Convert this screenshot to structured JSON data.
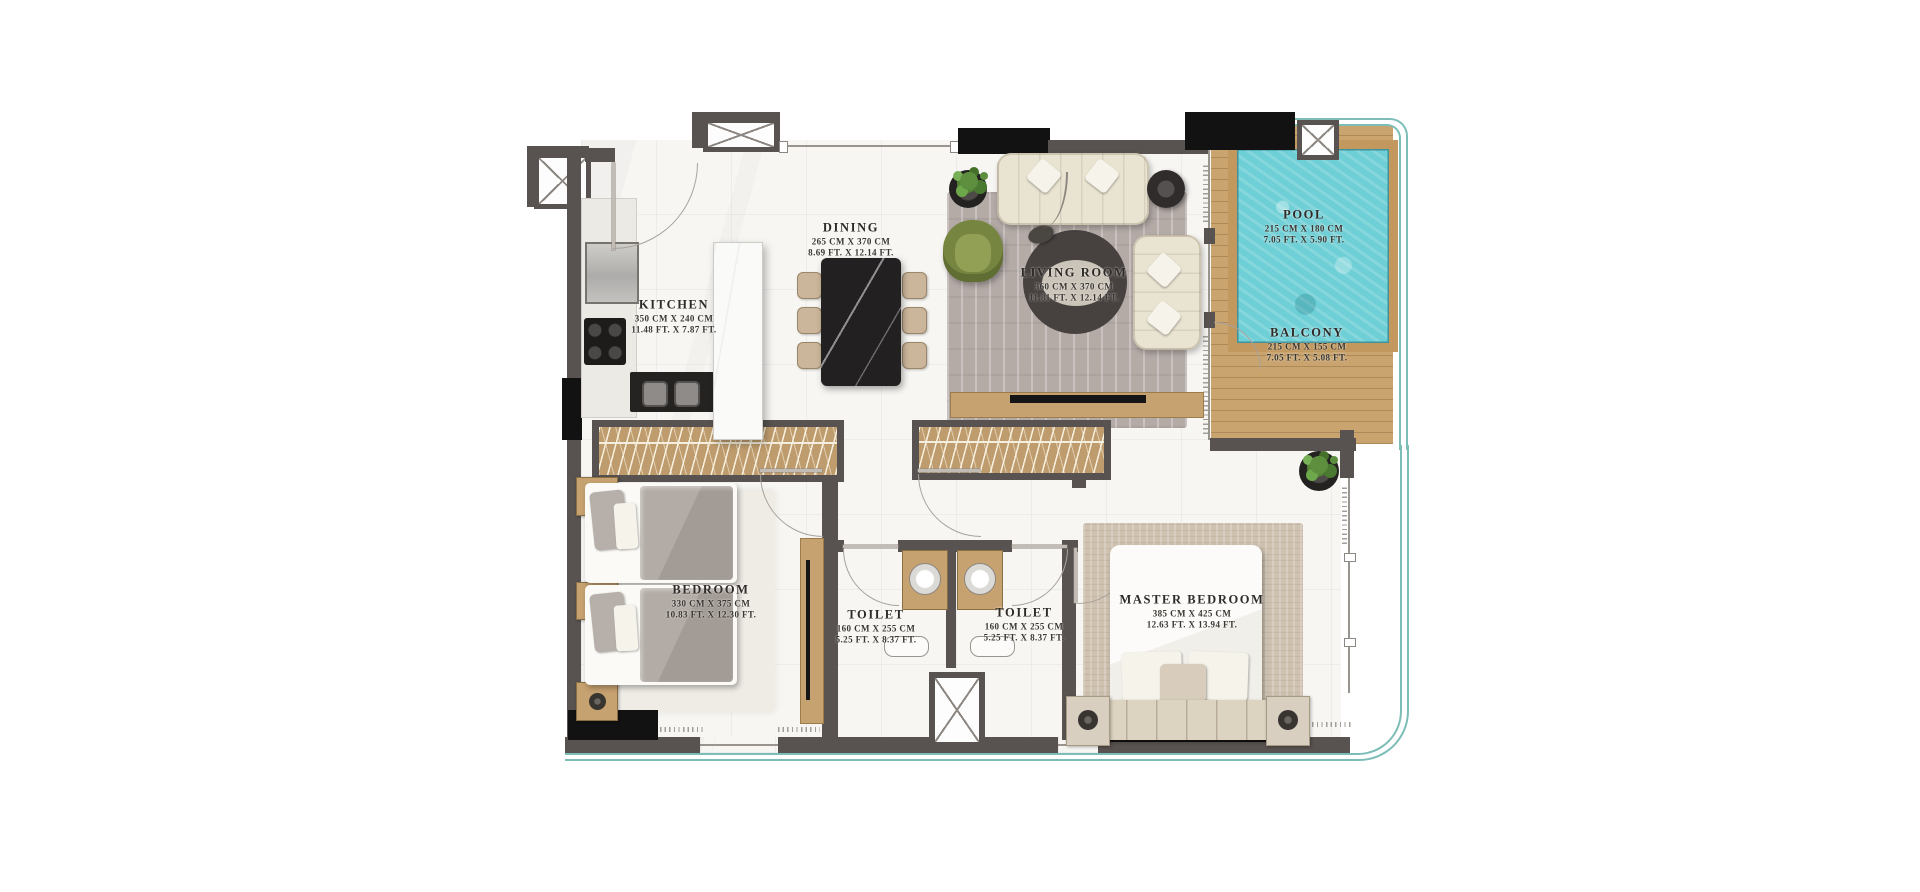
{
  "rooms": [
    {
      "id": "kitchen",
      "name": "KITCHEN",
      "cm": "350 CM X 240 CM",
      "ft": "11.48 FT. X 7.87 FT."
    },
    {
      "id": "dining",
      "name": "DINING",
      "cm": "265 CM X 370 CM",
      "ft": "8.69 FT. X 12.14 FT."
    },
    {
      "id": "living",
      "name": "LIVING ROOM",
      "cm": "360 CM X 370 CM",
      "ft": "11.81 FT. X 12.14 FT."
    },
    {
      "id": "pool",
      "name": "POOL",
      "cm": "215 CM X 180 CM",
      "ft": "7.05 FT. X 5.90 FT."
    },
    {
      "id": "balcony",
      "name": "BALCONY",
      "cm": "215 CM X 155 CM",
      "ft": "7.05 FT. X 5.08 FT."
    },
    {
      "id": "bedroom",
      "name": "BEDROOM",
      "cm": "330 CM X 375 CM",
      "ft": "10.83 FT. X 12.30 FT."
    },
    {
      "id": "toilet_1",
      "name": "TOILET",
      "cm": "160 CM X 255 CM",
      "ft": "5.25 FT. X 8.37 FT."
    },
    {
      "id": "toilet_2",
      "name": "TOILET",
      "cm": "160 CM X 255 CM",
      "ft": "5.25 FT. X 8.37 FT."
    },
    {
      "id": "master_bedroom",
      "name": "MASTER BEDROOM",
      "cm": "385 CM X 425 CM",
      "ft": "12.63 FT. X 13.94 FT."
    }
  ],
  "colors": {
    "wall": "#585250",
    "black_wall": "#121212",
    "wood": "#c7a271",
    "deck": "#c9a46f",
    "pool_water": "#6fcfd6",
    "glass": "#7dbdb8",
    "sofa": "#e9e3d1",
    "accent_chair": "#76853f",
    "living_rug": "#b4aba7",
    "master_rug": "#cfc2b0",
    "floor": "#f7f6f3"
  }
}
